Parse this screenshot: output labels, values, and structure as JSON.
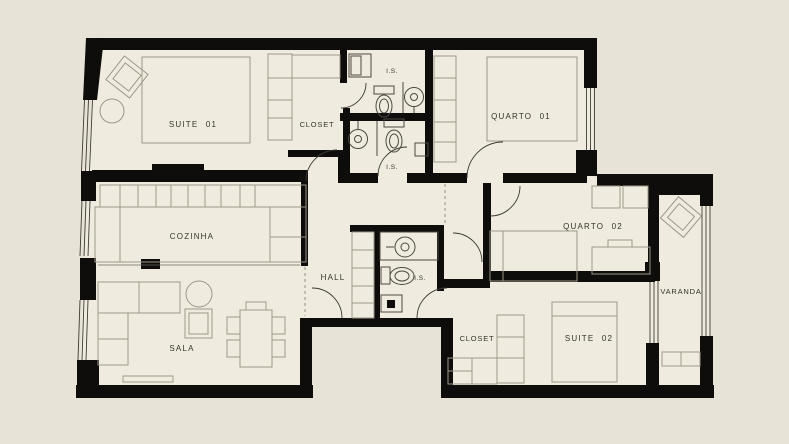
{
  "palette": {
    "background": "#e7e3d6",
    "floor": "#efecdf",
    "wall": "#0e0d0b",
    "furniture_line": "#9d978a",
    "fixture_line": "#4c4942",
    "label_color": "#35332c"
  },
  "floor_plan": {
    "type": "apartment-floor-plan",
    "rooms": {
      "suite01": {
        "label": "SUITE 01"
      },
      "closet01": {
        "label": "CLOSET"
      },
      "is01": {
        "label": "I.S."
      },
      "quarto01": {
        "label": "QUARTO 01"
      },
      "cozinha": {
        "label": "COZINHA"
      },
      "is02": {
        "label": "I.S."
      },
      "hall": {
        "label": "HALL"
      },
      "is03": {
        "label": "I.S."
      },
      "sala": {
        "label": "SALA"
      },
      "quarto02": {
        "label": "QUARTO 02"
      },
      "closet02": {
        "label": "CLOSET"
      },
      "suite02": {
        "label": "SUITE 02"
      },
      "varanda": {
        "label": "VARANDA"
      }
    }
  }
}
